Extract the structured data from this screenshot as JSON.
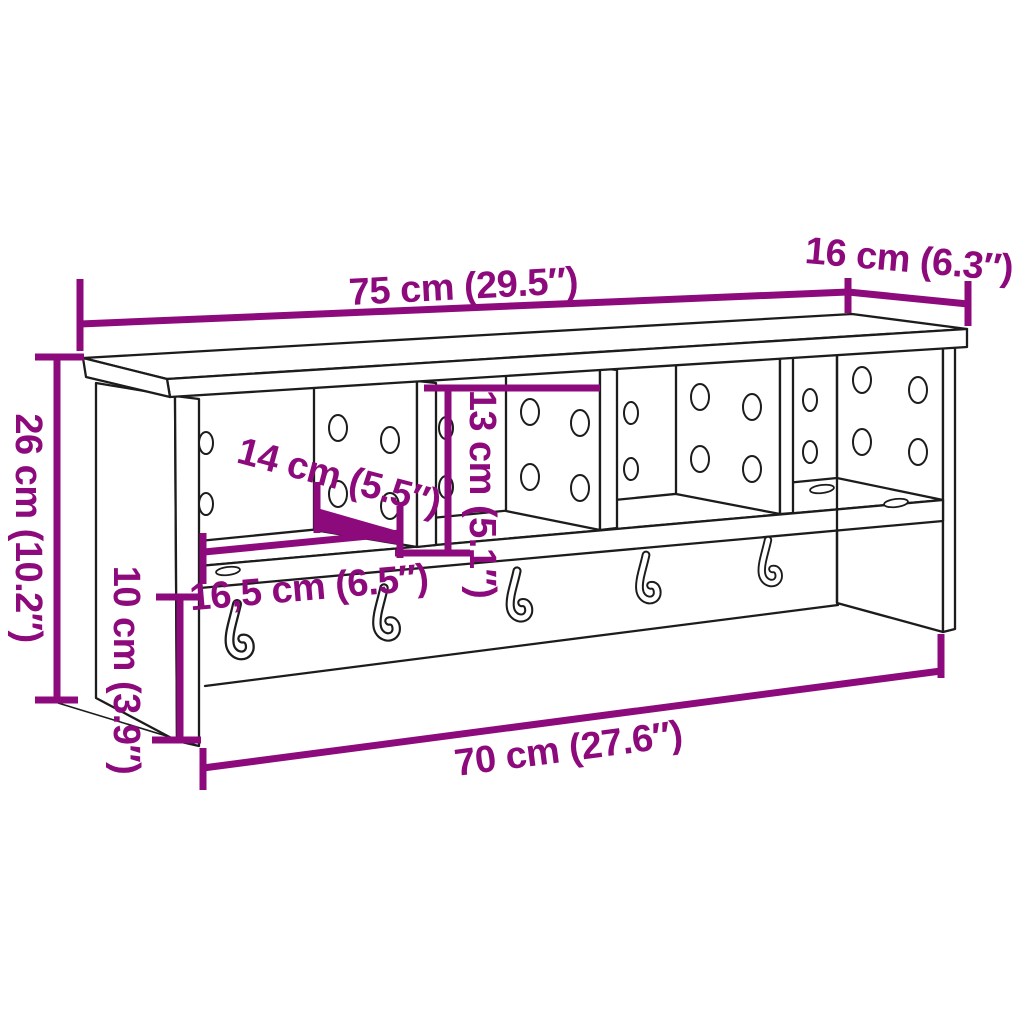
{
  "figure": {
    "type": "product-dimension-diagram",
    "product": "wall-mounted coat rack with compartments, shelf and hooks",
    "colors": {
      "dimension_annotation": "#8d0a7c",
      "drawing_line": "#1c1c1c",
      "background": "#ffffff"
    },
    "dims": {
      "top_width": "75 cm (29.5″)",
      "top_depth": "16 cm (6.3″)",
      "total_height": "26 cm (10.2″)",
      "compartment_height": "13 cm (5.1″)",
      "compartment_width": "14 cm (5.5″)",
      "shelf_depth": "16,5 cm (6.5″)",
      "rail_height": "10 cm (3.9″)",
      "bottom_width": "70 cm (27.6″)"
    }
  }
}
